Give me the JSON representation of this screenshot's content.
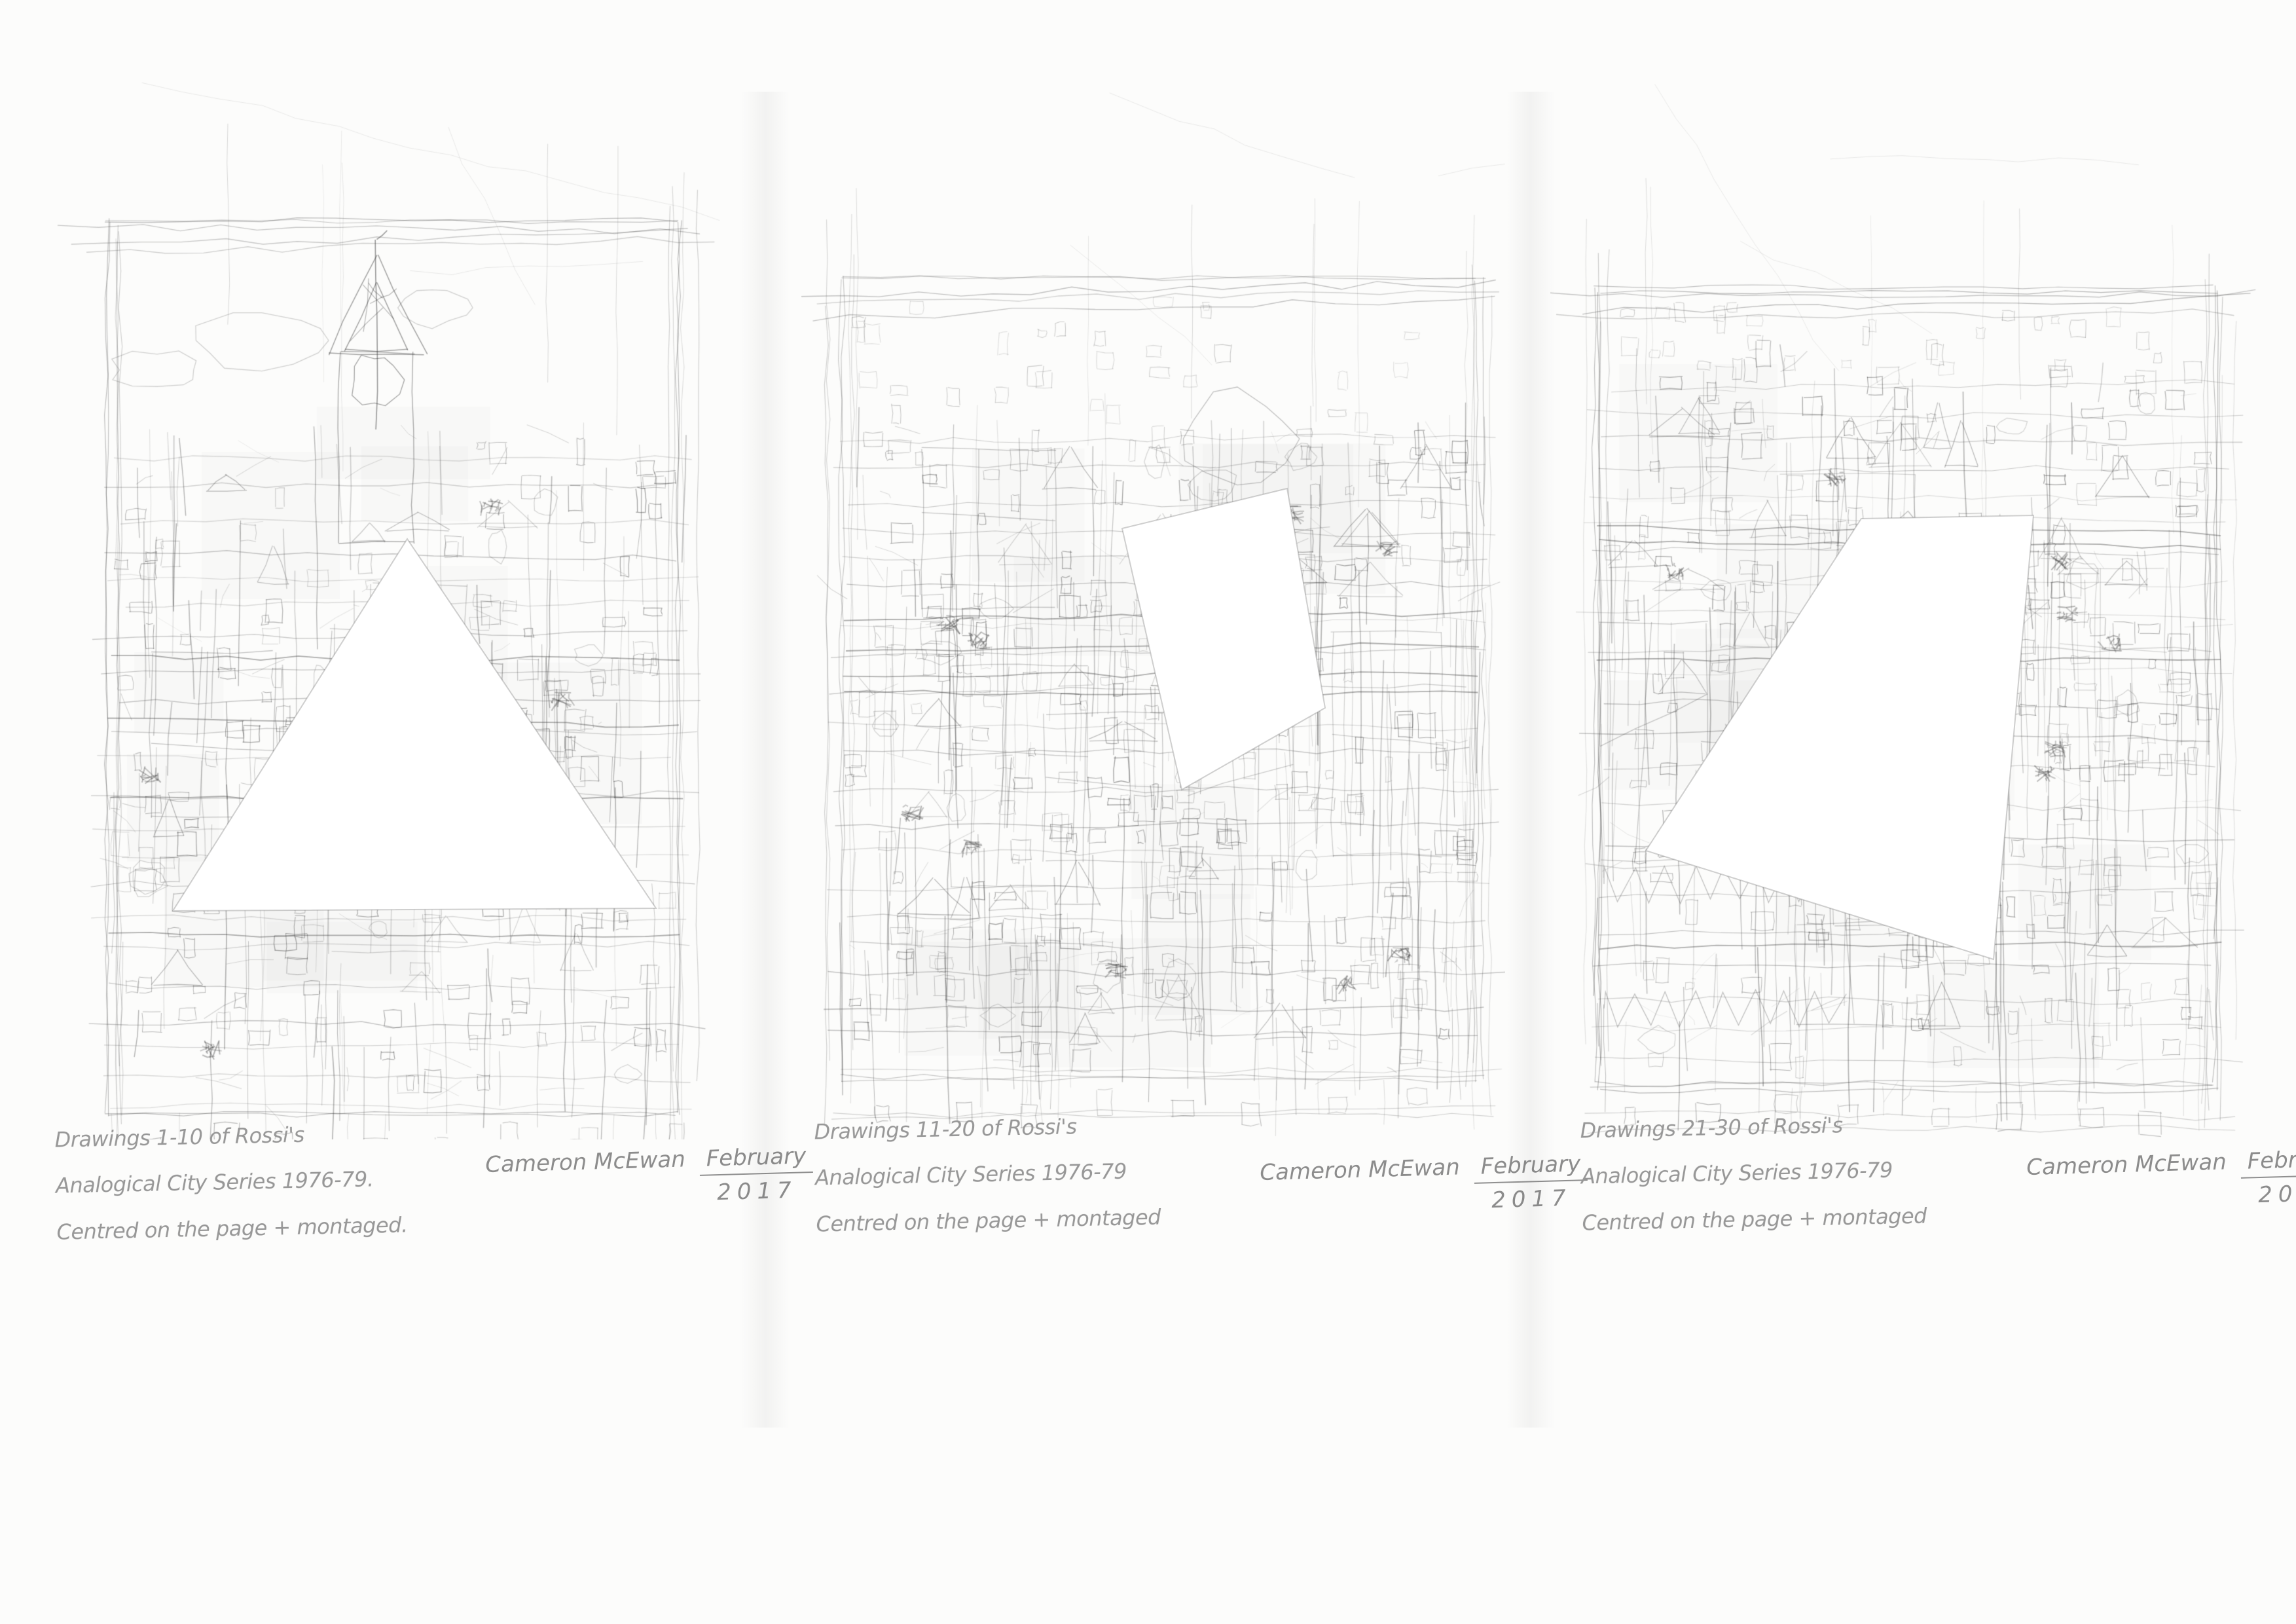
{
  "page": {
    "paper_color": "#fcfcfb",
    "pencil_color": "#6a6a6a",
    "handwriting_color": "#979797"
  },
  "panels": [
    {
      "id": "drawing-1",
      "cutout_shape": "triangle",
      "caption": {
        "line1": "Drawings 1-10 of Rossi's",
        "line2": "Analogical City Series 1976-79.",
        "line3": "Centred on the page + montaged."
      },
      "signature": {
        "name": "Cameron McEwan",
        "month": "February",
        "year": "2017"
      }
    },
    {
      "id": "drawing-2",
      "cutout_shape": "square",
      "caption": {
        "line1": "Drawings 11-20 of Rossi's",
        "line2": "Analogical City Series 1976-79",
        "line3": "Centred on the page + montaged"
      },
      "signature": {
        "name": "Cameron McEwan",
        "month": "February",
        "year": "2017"
      }
    },
    {
      "id": "drawing-3",
      "cutout_shape": "quadrilateral",
      "caption": {
        "line1": "Drawings 21-30 of Rossi's",
        "line2": "Analogical City Series 1976-79",
        "line3": "Centred on the page + montaged"
      },
      "signature": {
        "name": "Cameron McEwan",
        "month": "February",
        "year": "2017"
      }
    }
  ]
}
